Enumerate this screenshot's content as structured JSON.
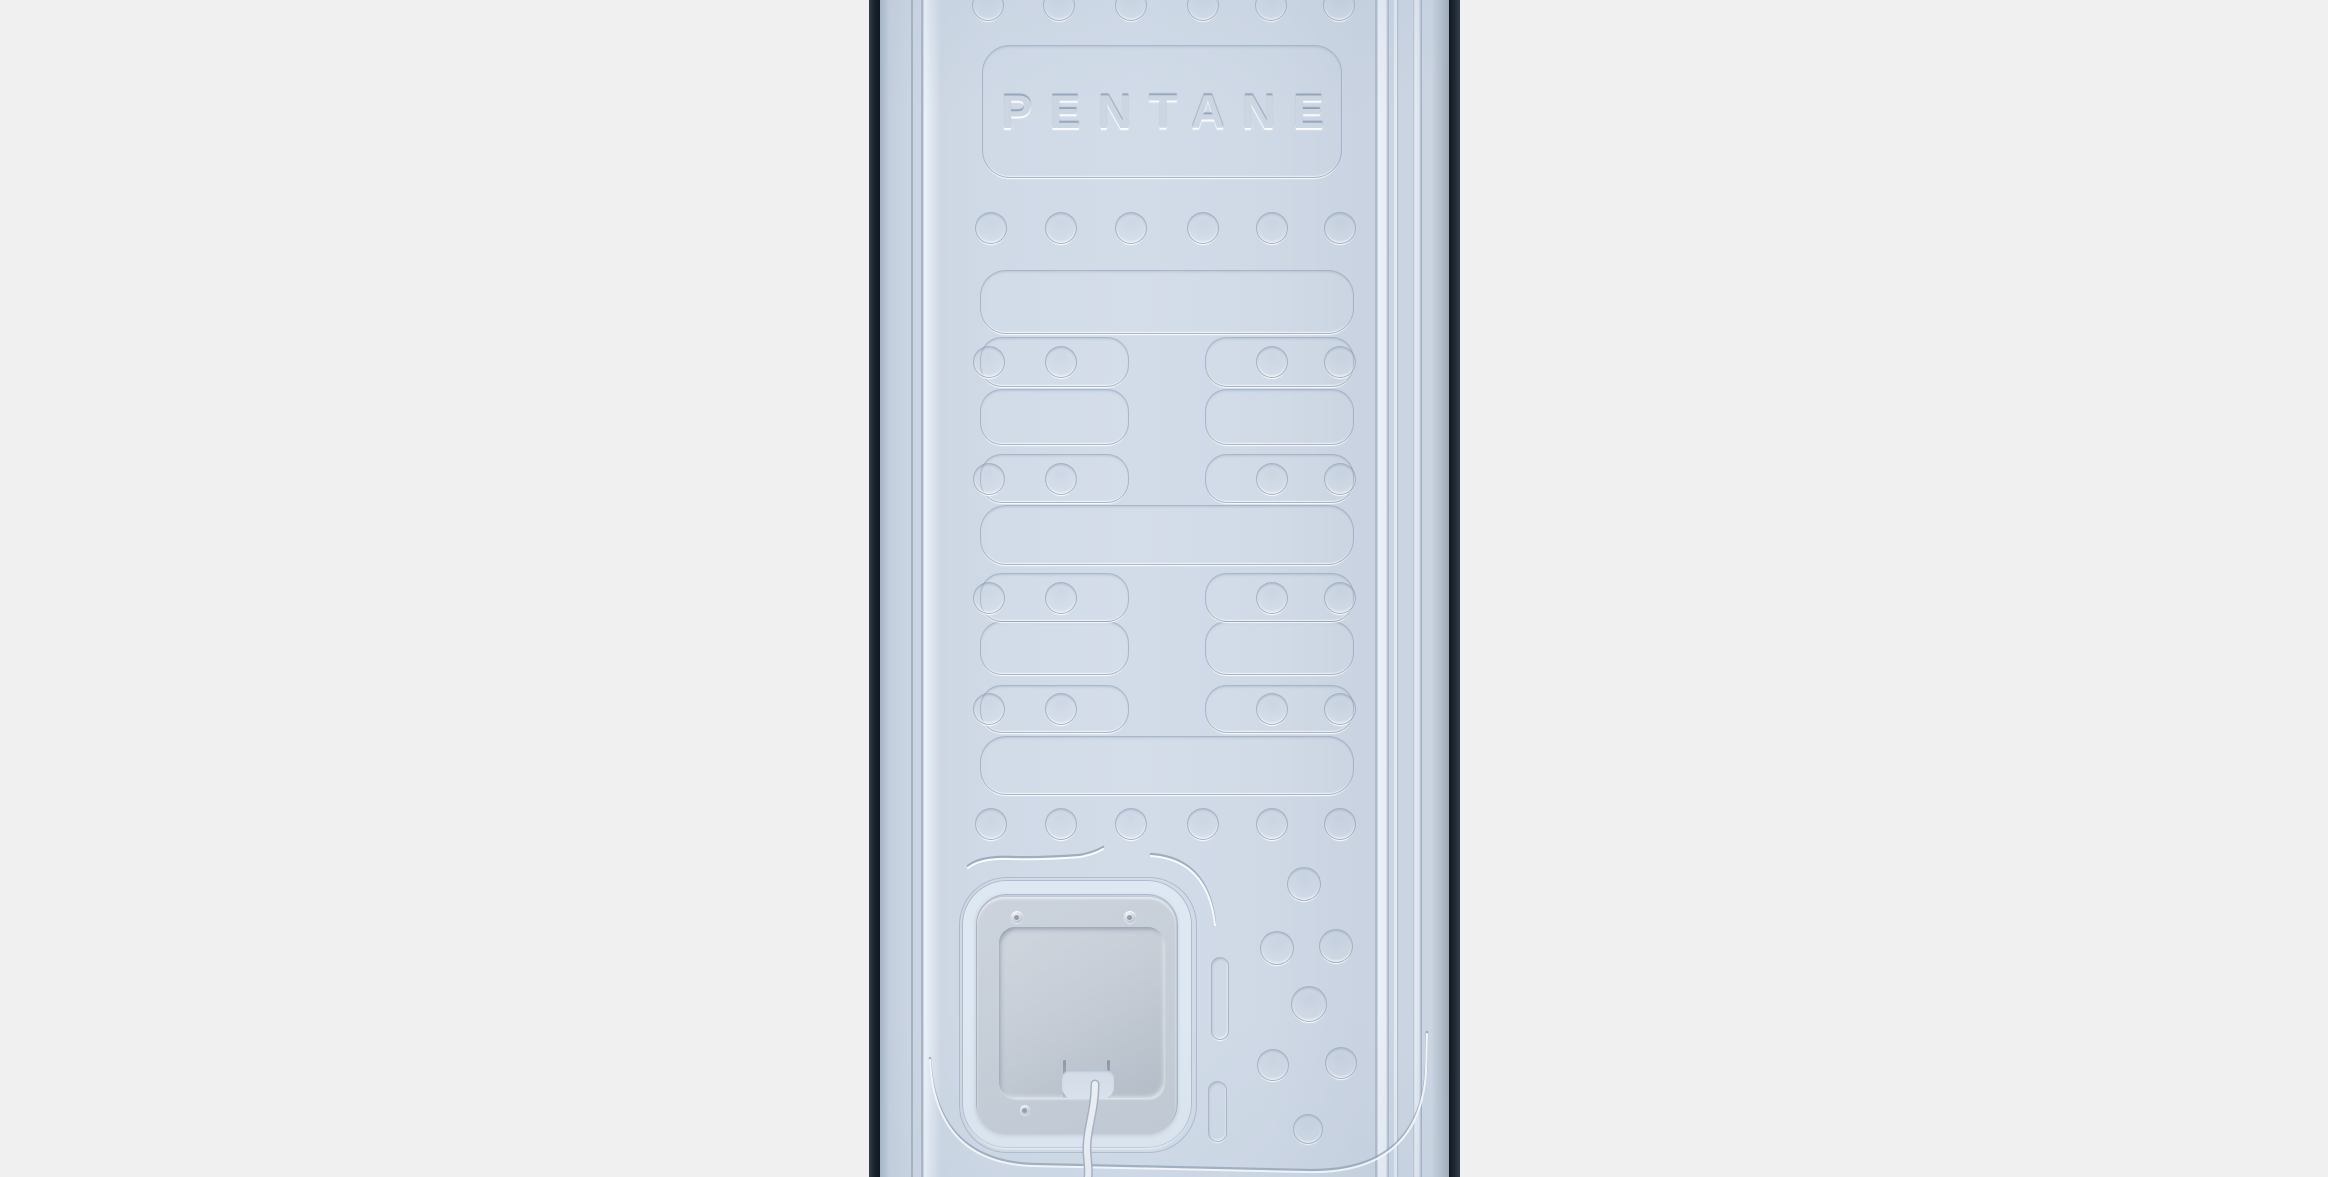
{
  "scene": {
    "label": "appliance-back-panel",
    "background_color": "#f0f0f1",
    "panel": {
      "edge_left": {
        "x": 869,
        "width": 11,
        "color": "#1b242e"
      },
      "edge_right": {
        "x": 1449,
        "width": 11,
        "color": "#1f2932"
      },
      "face": {
        "x": 880,
        "width": 569,
        "height": 1177,
        "color": "#cfd9e6"
      },
      "emboss_dark": "rgba(124,143,167,0.6)",
      "emboss_light": "rgba(255,255,255,0.9)"
    },
    "badge": {
      "x": 102,
      "y": 45,
      "w": 358,
      "h": 131,
      "r": 28,
      "text": "PENTANE"
    },
    "dimple_r": 15,
    "dimple_rows": [
      {
        "cy": 4,
        "cx": [
          107,
          178,
          250,
          322,
          390,
          458
        ]
      },
      {
        "cy": 227,
        "cx": [
          110,
          180,
          250,
          322,
          391,
          459
        ]
      },
      {
        "cy": 823,
        "cx": [
          110,
          180,
          250,
          322,
          391,
          459
        ]
      }
    ],
    "channels_full": [
      {
        "x": 100,
        "y": 270,
        "w": 372,
        "h": 62,
        "r": 26
      },
      {
        "x": 100,
        "y": 505,
        "w": 372,
        "h": 58,
        "r": 26
      },
      {
        "x": 100,
        "y": 736,
        "w": 372,
        "h": 57,
        "r": 26
      }
    ],
    "split_left": {
      "x": 100,
      "w": 147
    },
    "split_right": {
      "x": 325,
      "w": 147
    },
    "channels_split": [
      {
        "y": 389,
        "h": 54,
        "r": 22
      },
      {
        "y": 621,
        "h": 52,
        "r": 22
      }
    ],
    "pair_rows": [
      {
        "y": 337,
        "h": 48,
        "r": 22
      },
      {
        "y": 454,
        "h": 47,
        "r": 22
      },
      {
        "y": 573,
        "h": 47,
        "r": 22
      },
      {
        "y": 685,
        "h": 46,
        "r": 22
      }
    ],
    "pair_cx_left": [
      108,
      180
    ],
    "pair_cx_right": [
      391,
      459
    ],
    "pills": [
      {
        "x": 331,
        "y": 957,
        "w": 16,
        "h": 81
      },
      {
        "x": 328,
        "y": 1081,
        "w": 17,
        "h": 59
      }
    ],
    "cluster_dimples": [
      {
        "cx": 423,
        "cy": 883,
        "r": 16
      },
      {
        "cx": 396,
        "cy": 947,
        "r": 16
      },
      {
        "cx": 455,
        "cy": 945,
        "r": 16
      },
      {
        "cx": 428,
        "cy": 1003,
        "r": 17
      },
      {
        "cx": 392,
        "cy": 1064,
        "r": 15
      },
      {
        "cx": 460,
        "cy": 1062,
        "r": 15
      },
      {
        "cx": 427,
        "cy": 1128,
        "r": 14
      }
    ],
    "access_panel": {
      "frame_outline": {
        "x": 79,
        "y": 877,
        "w": 236,
        "h": 274,
        "r": 48
      },
      "frame": {
        "x": 83,
        "y": 881,
        "w": 228,
        "h": 266,
        "r": 44
      },
      "plate": {
        "x": 97,
        "y": 897,
        "w": 199,
        "h": 237,
        "r": 28
      },
      "recess": {
        "x": 119,
        "y": 927,
        "w": 165,
        "h": 171,
        "r": 16
      },
      "notch": {
        "x": 182,
        "y": 1070,
        "w": 52,
        "h": 29
      },
      "slots": [
        {
          "x": 183,
          "y": 1060,
          "w": 3,
          "h": 38
        },
        {
          "x": 227,
          "y": 1060,
          "w": 3,
          "h": 38
        }
      ],
      "screws": [
        {
          "cx": 137,
          "cy": 917,
          "r": 6
        },
        {
          "cx": 250,
          "cy": 917,
          "r": 6
        },
        {
          "cx": 145,
          "cy": 1110,
          "r": 5
        }
      ]
    },
    "paths": {
      "wave": "M88,866 Q100,856 130,857 T200,855 Q215,852 223,847",
      "arc": "M271,854 Q328,858 335,923",
      "trim": "M50,1058 Q55,1160 152,1164 L426,1170 Q539,1173 546,1070 L547,1032",
      "wire": "M215,1084 C215,1112 206,1130 207,1152 C208,1166 209,1171 208,1177"
    }
  }
}
